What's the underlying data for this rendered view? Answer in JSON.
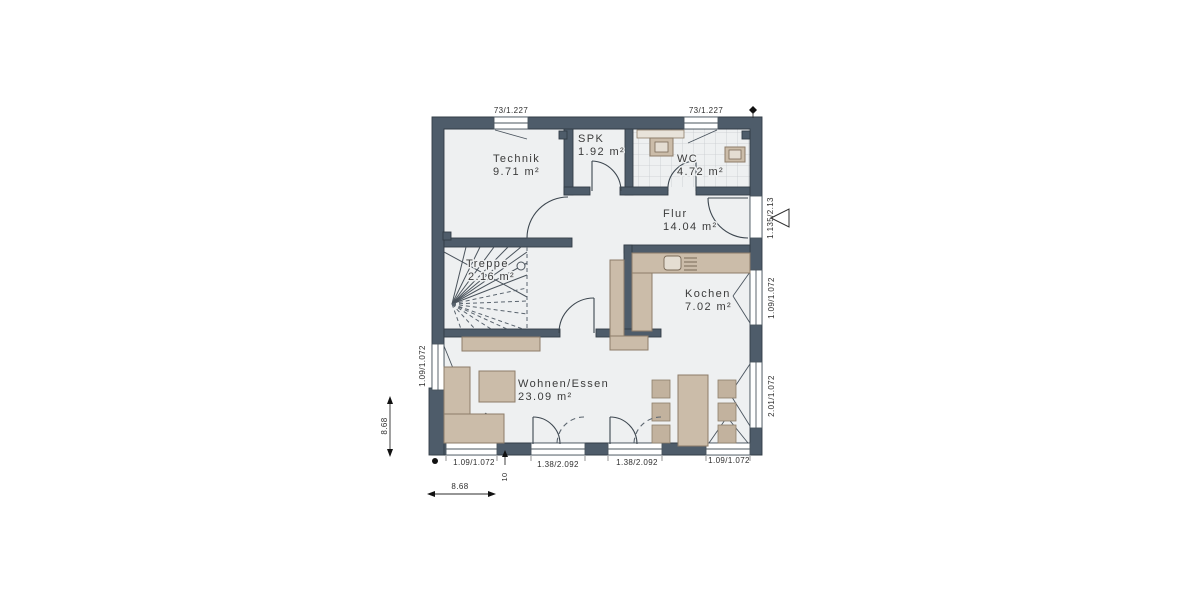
{
  "plan": {
    "title": "Erdgeschoss Grundriss",
    "rooms": [
      {
        "name": "Technik",
        "area": "9.71 m²"
      },
      {
        "name": "SPK",
        "area": "1.92 m²"
      },
      {
        "name": "WC",
        "area": "4.72 m²"
      },
      {
        "name": "Flur",
        "area": "14.04 m²"
      },
      {
        "name": "Treppe",
        "area": "2.16 m²"
      },
      {
        "name": "Kochen",
        "area": "7.02 m²"
      },
      {
        "name": "Wohnen/Essen",
        "area": "23.09 m²"
      }
    ],
    "dims": {
      "top_window_1": "73/1.227",
      "top_window_2": "73/1.227",
      "entry_door": "1.135/2.13",
      "kitchen_window": "1.09/1.072",
      "dining_window": "2.01/1.072",
      "left_window": "1.09/1.072",
      "bottom_window_left": "1.09/1.072",
      "terrace_door_1": "1.38/2.092",
      "terrace_door_2": "1.38/2.092",
      "bottom_window_right": "1.09/1.072",
      "total_width": "8.68",
      "total_height": "8.68",
      "step": "10"
    },
    "colors": {
      "wall": "#4e5c6a",
      "floor": "#eef0f1",
      "furniture": "#cbbca9",
      "line": "#3d4750"
    }
  }
}
